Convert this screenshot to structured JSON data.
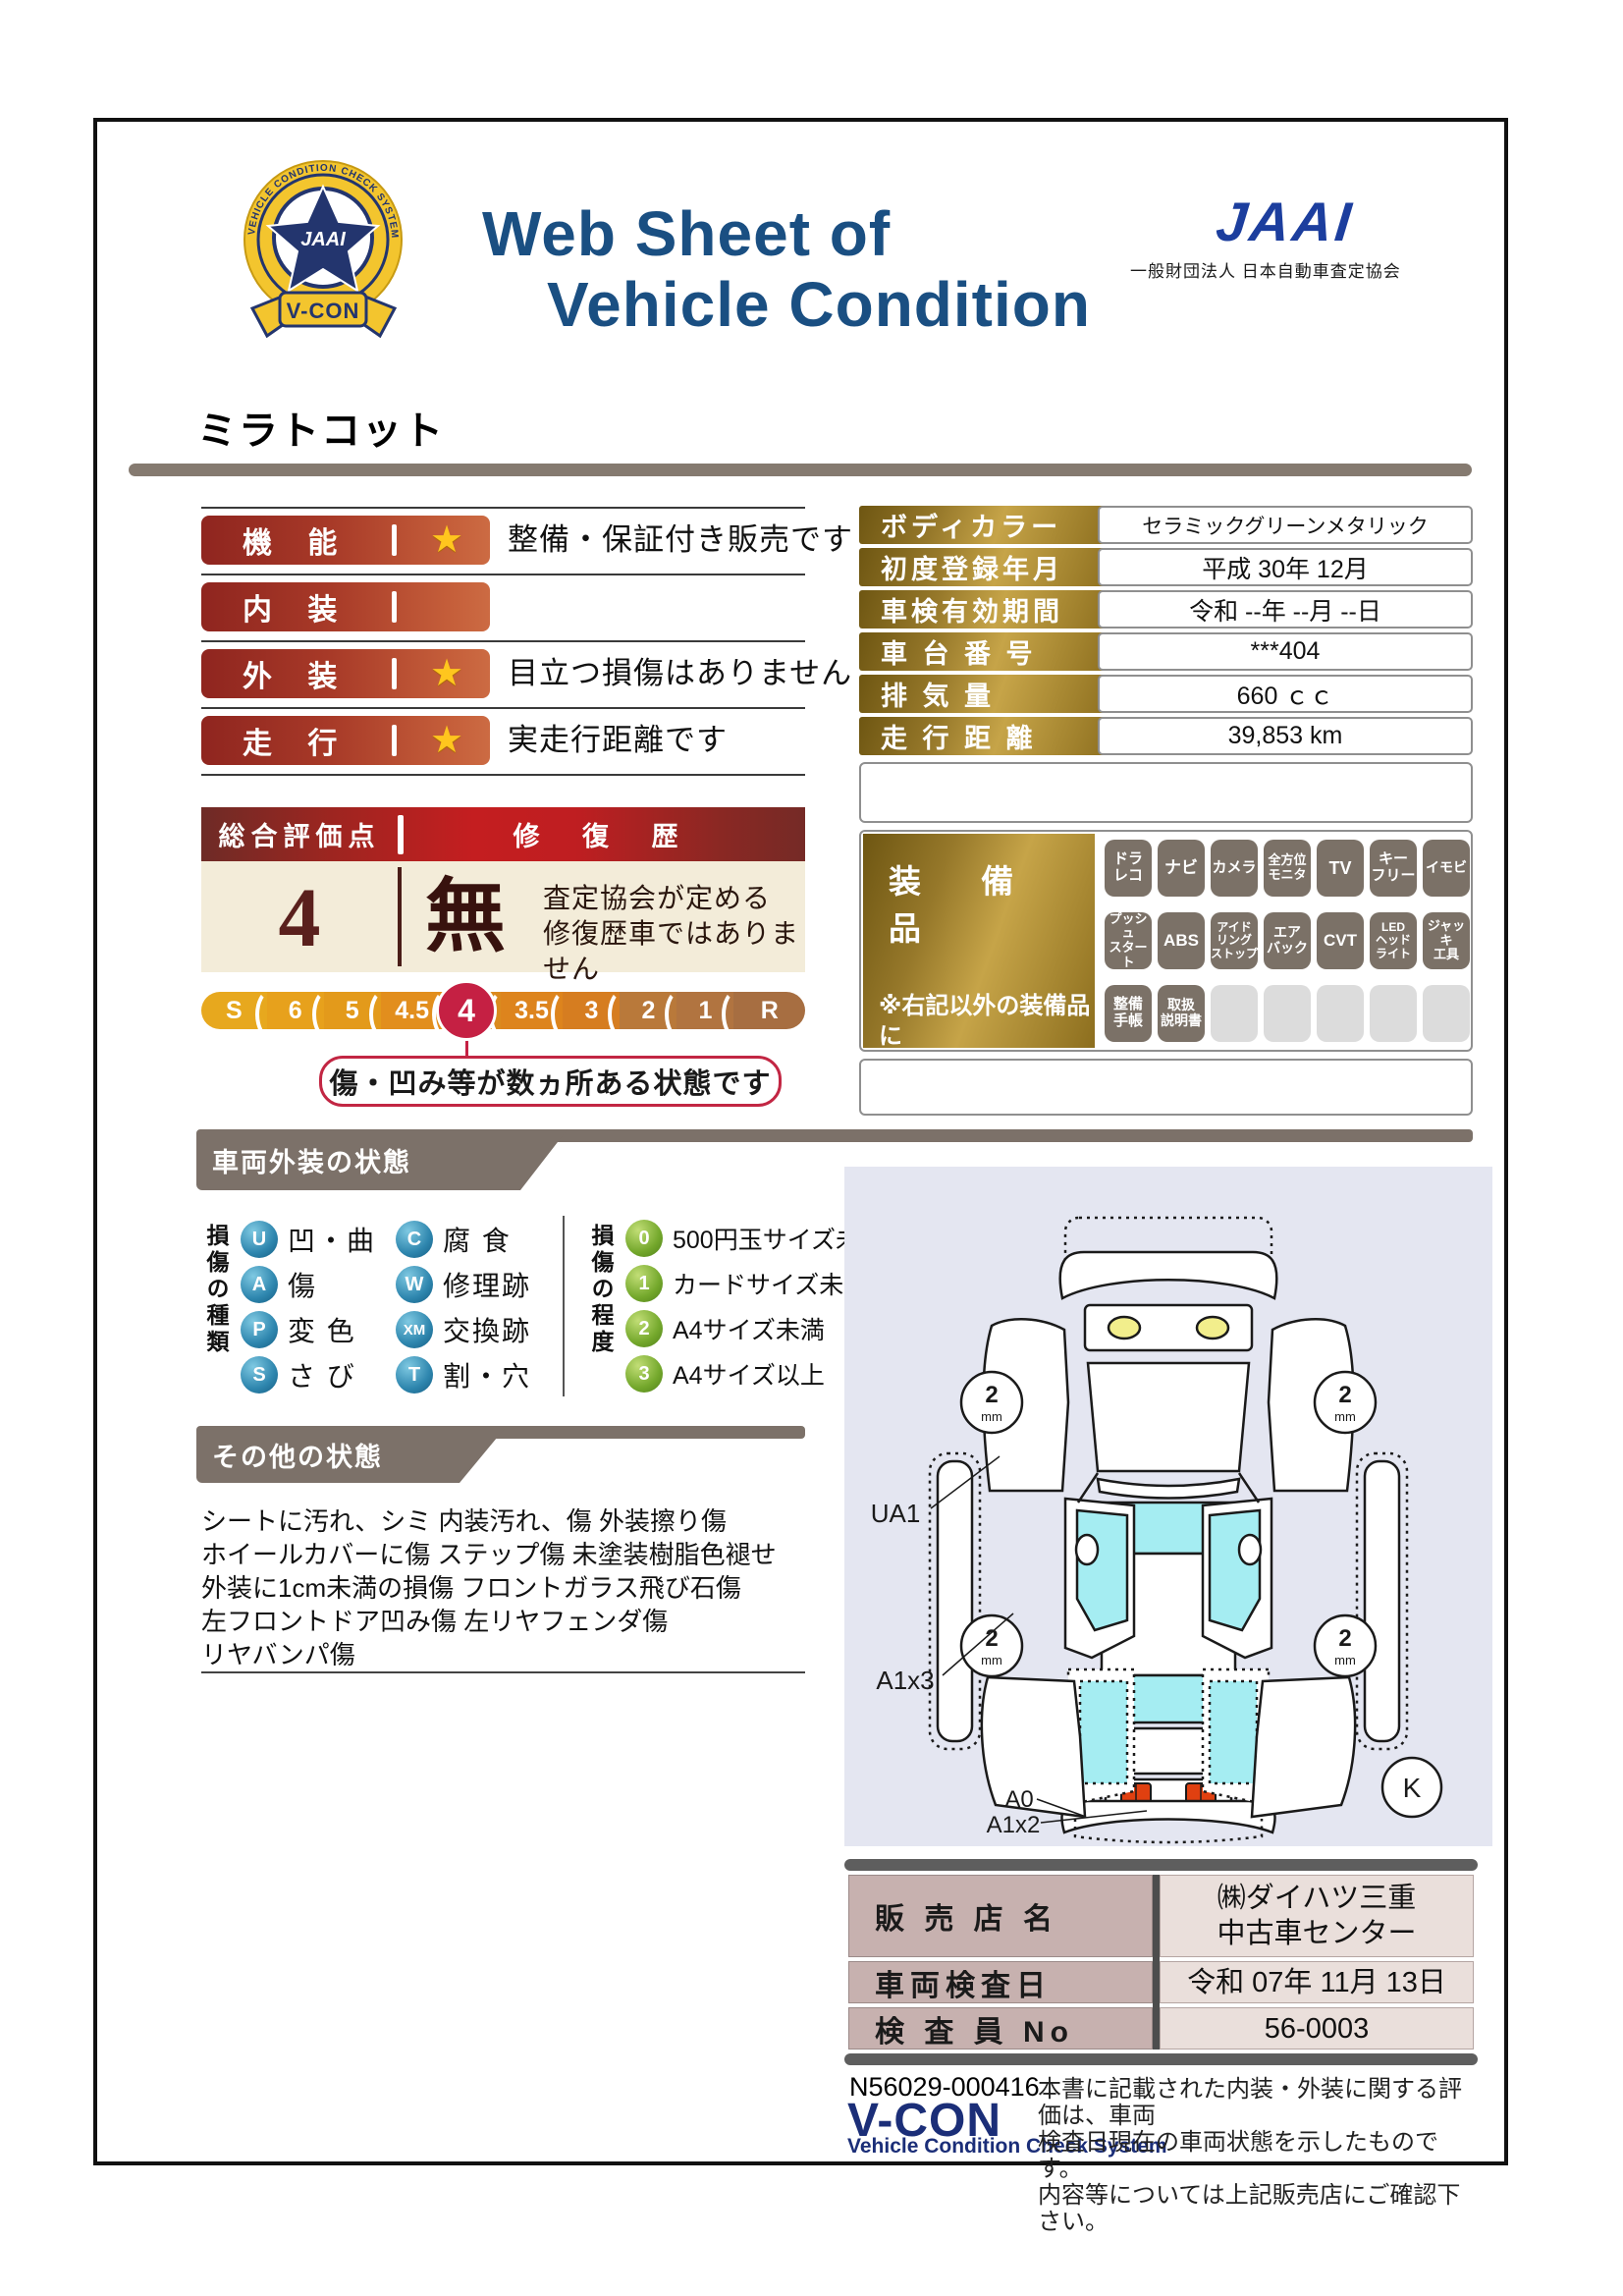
{
  "colors": {
    "navy_title": "#1A4F82",
    "jaai_blue": "#1C3E9E",
    "accent_red": "#C41E20",
    "crimson": "#C52043",
    "maroon_text": "#5A201D",
    "cream": "#F3ECD9",
    "gold_dark": "#6E5612",
    "gold_light": "#C6A448",
    "bar_red_left": "#8F251F",
    "bar_red_right": "#CC6B43",
    "badge_gray": "#7B7167",
    "badge_off": "#DCDCDC",
    "sphere_blue": "#2E86AE",
    "sphere_green": "#74A82C",
    "section_gray": "#7C7169",
    "diagram_bg": "#E4E6F1",
    "window_cyan": "#A5EDF2",
    "dealer_label_pink": "#C7B1AF",
    "dealer_value_pink": "#EADFDB",
    "star_gold": "#FFC61E"
  },
  "header": {
    "title_line1": "Web Sheet of",
    "title_line2": "Vehicle Condition",
    "jaai_logo": "JAAI",
    "jaai_subtitle": "一般財団法人 日本自動車査定協会",
    "badge": {
      "center": "JAAI",
      "ring_text": "VEHICLE CONDITION CHECK SYSTEM",
      "ribbon": "V-CON"
    }
  },
  "vehicle_name": "ミラトコット",
  "ratings": [
    {
      "label": "機  能",
      "comment": "整備・保証付き販売です"
    },
    {
      "label": "内  装",
      "comment": ""
    },
    {
      "label": "外  装",
      "comment": "目立つ損傷はありません"
    },
    {
      "label": "走  行",
      "comment": "実走行距離です"
    }
  ],
  "overall": {
    "header_left": "総合評価点",
    "header_right": "修 復 歴",
    "score": "4",
    "repair_flag": "無",
    "repair_note": "査定協会が定める\n修復歴車ではありません",
    "scale": [
      "S",
      "6",
      "5",
      "4.5",
      "4",
      "3.5",
      "3",
      "2",
      "1",
      "R"
    ],
    "selected": "4",
    "callout": "傷・凹み等が数ヵ所ある状態です"
  },
  "info_table": [
    {
      "label": "ボディカラー",
      "value": "セラミックグリーンメタリック"
    },
    {
      "label": "初度登録年月",
      "value": "平成 30年 12月"
    },
    {
      "label": "車検有効期間",
      "value": "令和 --年 --月 --日"
    },
    {
      "label": "車 台 番 号",
      "value": "***404"
    },
    {
      "label": "排  気  量",
      "value": "660 ｃｃ"
    },
    {
      "label": "走 行 距 離",
      "value": "39,853 km"
    }
  ],
  "equipment": {
    "title": "装 備 品",
    "note": "※右記以外の装備品に\nついてはスタッフに\nお尋ねください。",
    "row1": [
      "ドラ\nレコ",
      "ナビ",
      "カメラ",
      "全方位\nモニタ",
      "TV",
      "キー\nフリー",
      "イモビ"
    ],
    "row2": [
      "プッシュ\nスタート",
      "ABS",
      "アイド\nリング\nストップ",
      "エア\nバック",
      "CVT",
      "LED\nヘッド\nライト",
      "ジャッキ\n工具"
    ],
    "row3": [
      "整備\n手帳",
      "取扱\n説明書"
    ]
  },
  "exterior_section": {
    "title": "車両外装の状態",
    "type_label": "損傷の種類",
    "types": [
      {
        "code": "U",
        "label": "凹・曲"
      },
      {
        "code": "A",
        "label": "傷"
      },
      {
        "code": "P",
        "label": "変 色"
      },
      {
        "code": "S",
        "label": "さ び"
      },
      {
        "code": "C",
        "label": "腐 食"
      },
      {
        "code": "W",
        "label": "修理跡"
      },
      {
        "code": "XM",
        "label": "交換跡"
      },
      {
        "code": "T",
        "label": "割・穴"
      }
    ],
    "degree_label": "損傷の程度",
    "degrees": [
      {
        "code": "0",
        "label": "500円玉サイズ未満"
      },
      {
        "code": "1",
        "label": "カードサイズ未満"
      },
      {
        "code": "2",
        "label": "A4サイズ未満"
      },
      {
        "code": "3",
        "label": "A4サイズ以上"
      }
    ]
  },
  "other_section": {
    "title": "その他の状態",
    "lines": "シートに汚れ、シミ 内装汚れ、傷 外装擦り傷\nホイールカバーに傷 ステップ傷 未塗装樹脂色褪せ\n外装に1cm未満の損傷 フロントガラス飛び石傷\n左フロントドア凹み傷 左リヤフェンダ傷\nリヤバンパ傷"
  },
  "diagram": {
    "label_ua1": "UA1",
    "label_a1x3": "A1x3",
    "label_a0": "A0",
    "label_a1x2": "A1x2",
    "label_k": "K",
    "wheel_tread": "2",
    "wheel_unit": "mm"
  },
  "dealer_table": [
    {
      "label": "販 売 店 名",
      "value": "㈱ダイハツ三重\n中古車センター"
    },
    {
      "label": "車両検査日",
      "value": "令和 07年 11月 13日"
    },
    {
      "label": "検 査 員 No",
      "value": "56-0003"
    }
  ],
  "footer": {
    "serial": "N56029-000416",
    "vcon": "V-CON",
    "vcon_sub": "Vehicle Condition Check System",
    "disclaimer": "本書に記載された内装・外装に関する評価は、車両\n検査日現在の車両状態を示したものです。\n内容等については上記販売店にご確認下さい。"
  }
}
